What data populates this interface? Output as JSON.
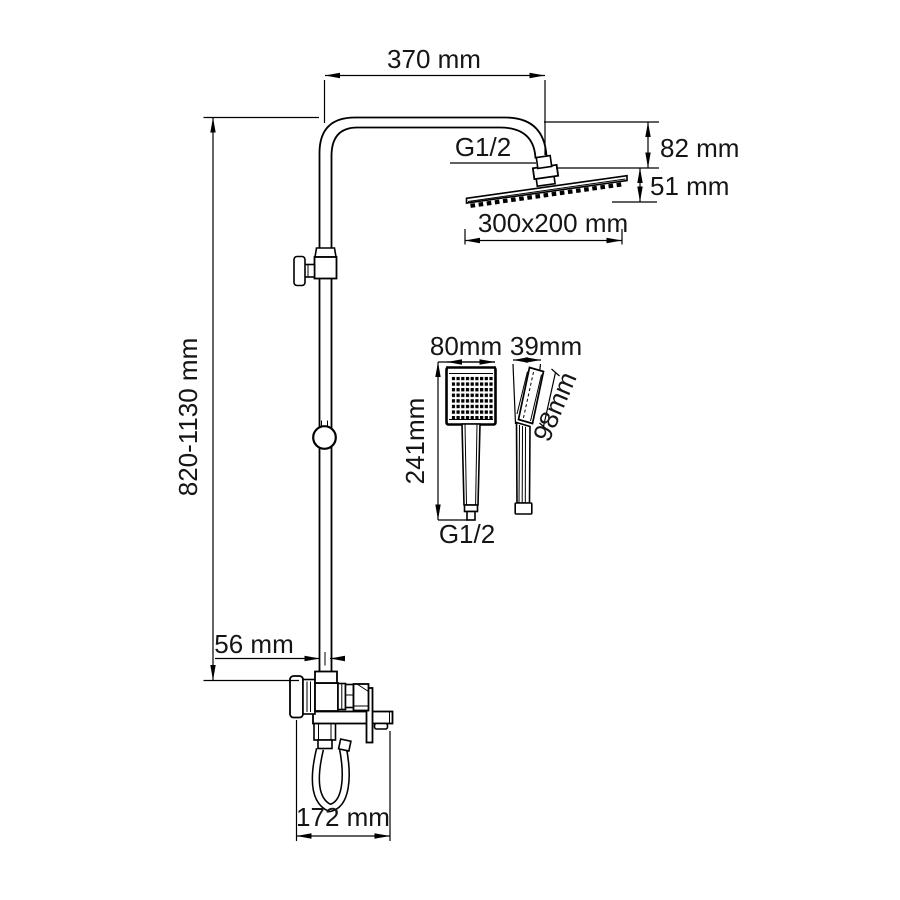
{
  "title": "Shower system dimensional drawing",
  "colors": {
    "line": "#000000",
    "text": "#151515",
    "background": "#ffffff"
  },
  "dimensions": {
    "top_width": "370 mm",
    "head_connection": "G1/2",
    "head_offset_vertical": "82 mm",
    "head_drop": "51 mm",
    "overhead_size": "300x200 mm",
    "column_height_range": "820-1130 mm",
    "handshower_width": "80mm",
    "handshower_depth": "39mm",
    "handshower_length": "241mm",
    "handshower_head_length": "98mm",
    "handshower_connection": "G1/2",
    "wall_to_column": "56 mm",
    "spout_span": "172 mm"
  }
}
